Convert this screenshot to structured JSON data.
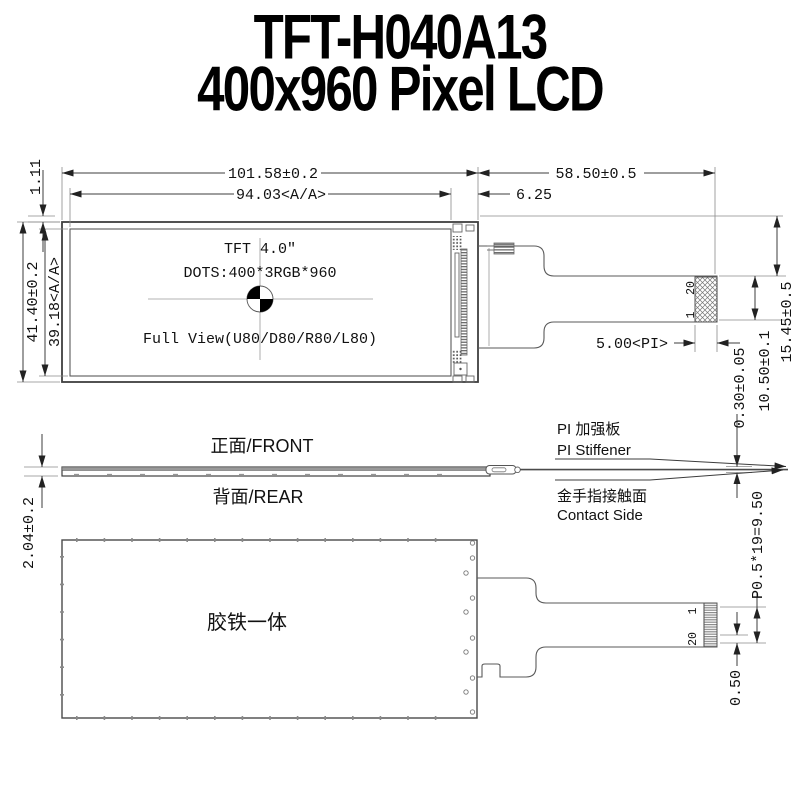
{
  "title": {
    "line1": "TFT-H040A13",
    "line2": "400x960 Pixel LCD"
  },
  "panel": {
    "line1": "TFT 4.0″",
    "line2": "DOTS:400*3RGB*960",
    "line3": "Full View(U80/D80/R80/L80)"
  },
  "dims": {
    "outer_w": "101.58±0.2",
    "aa_w": "94.03<A/A>",
    "ledge_w": "6.25",
    "fpc_len": "58.50±0.5",
    "top_gap": "1.11",
    "outer_h": "41.40±0.2",
    "aa_h": "39.18<A/A>",
    "pi_len": "5.00<PI>",
    "contact_drop": "15.45±0.5",
    "conn_h": "10.50±0.1",
    "module_t": "2.04±0.2",
    "fpc_t": "0.30±0.05",
    "pitch_total": "P0.5*19=9.50",
    "pitch": "0.50"
  },
  "pins": {
    "top_first": "20",
    "top_last": "1",
    "bottom_first": "1",
    "bottom_last": "20"
  },
  "labels": {
    "front": "正面/FRONT",
    "rear": "背面/REAR",
    "stiffener_cn": "PI 加强板",
    "stiffener_en": "PI Stiffener",
    "contact_cn": "金手指接触面",
    "contact_en": "Contact Side",
    "rear_body": "胶铁一体"
  },
  "colors": {
    "line": "#3f3f3f",
    "text": "#111111",
    "background": "#ffffff",
    "shading": "#999999"
  }
}
